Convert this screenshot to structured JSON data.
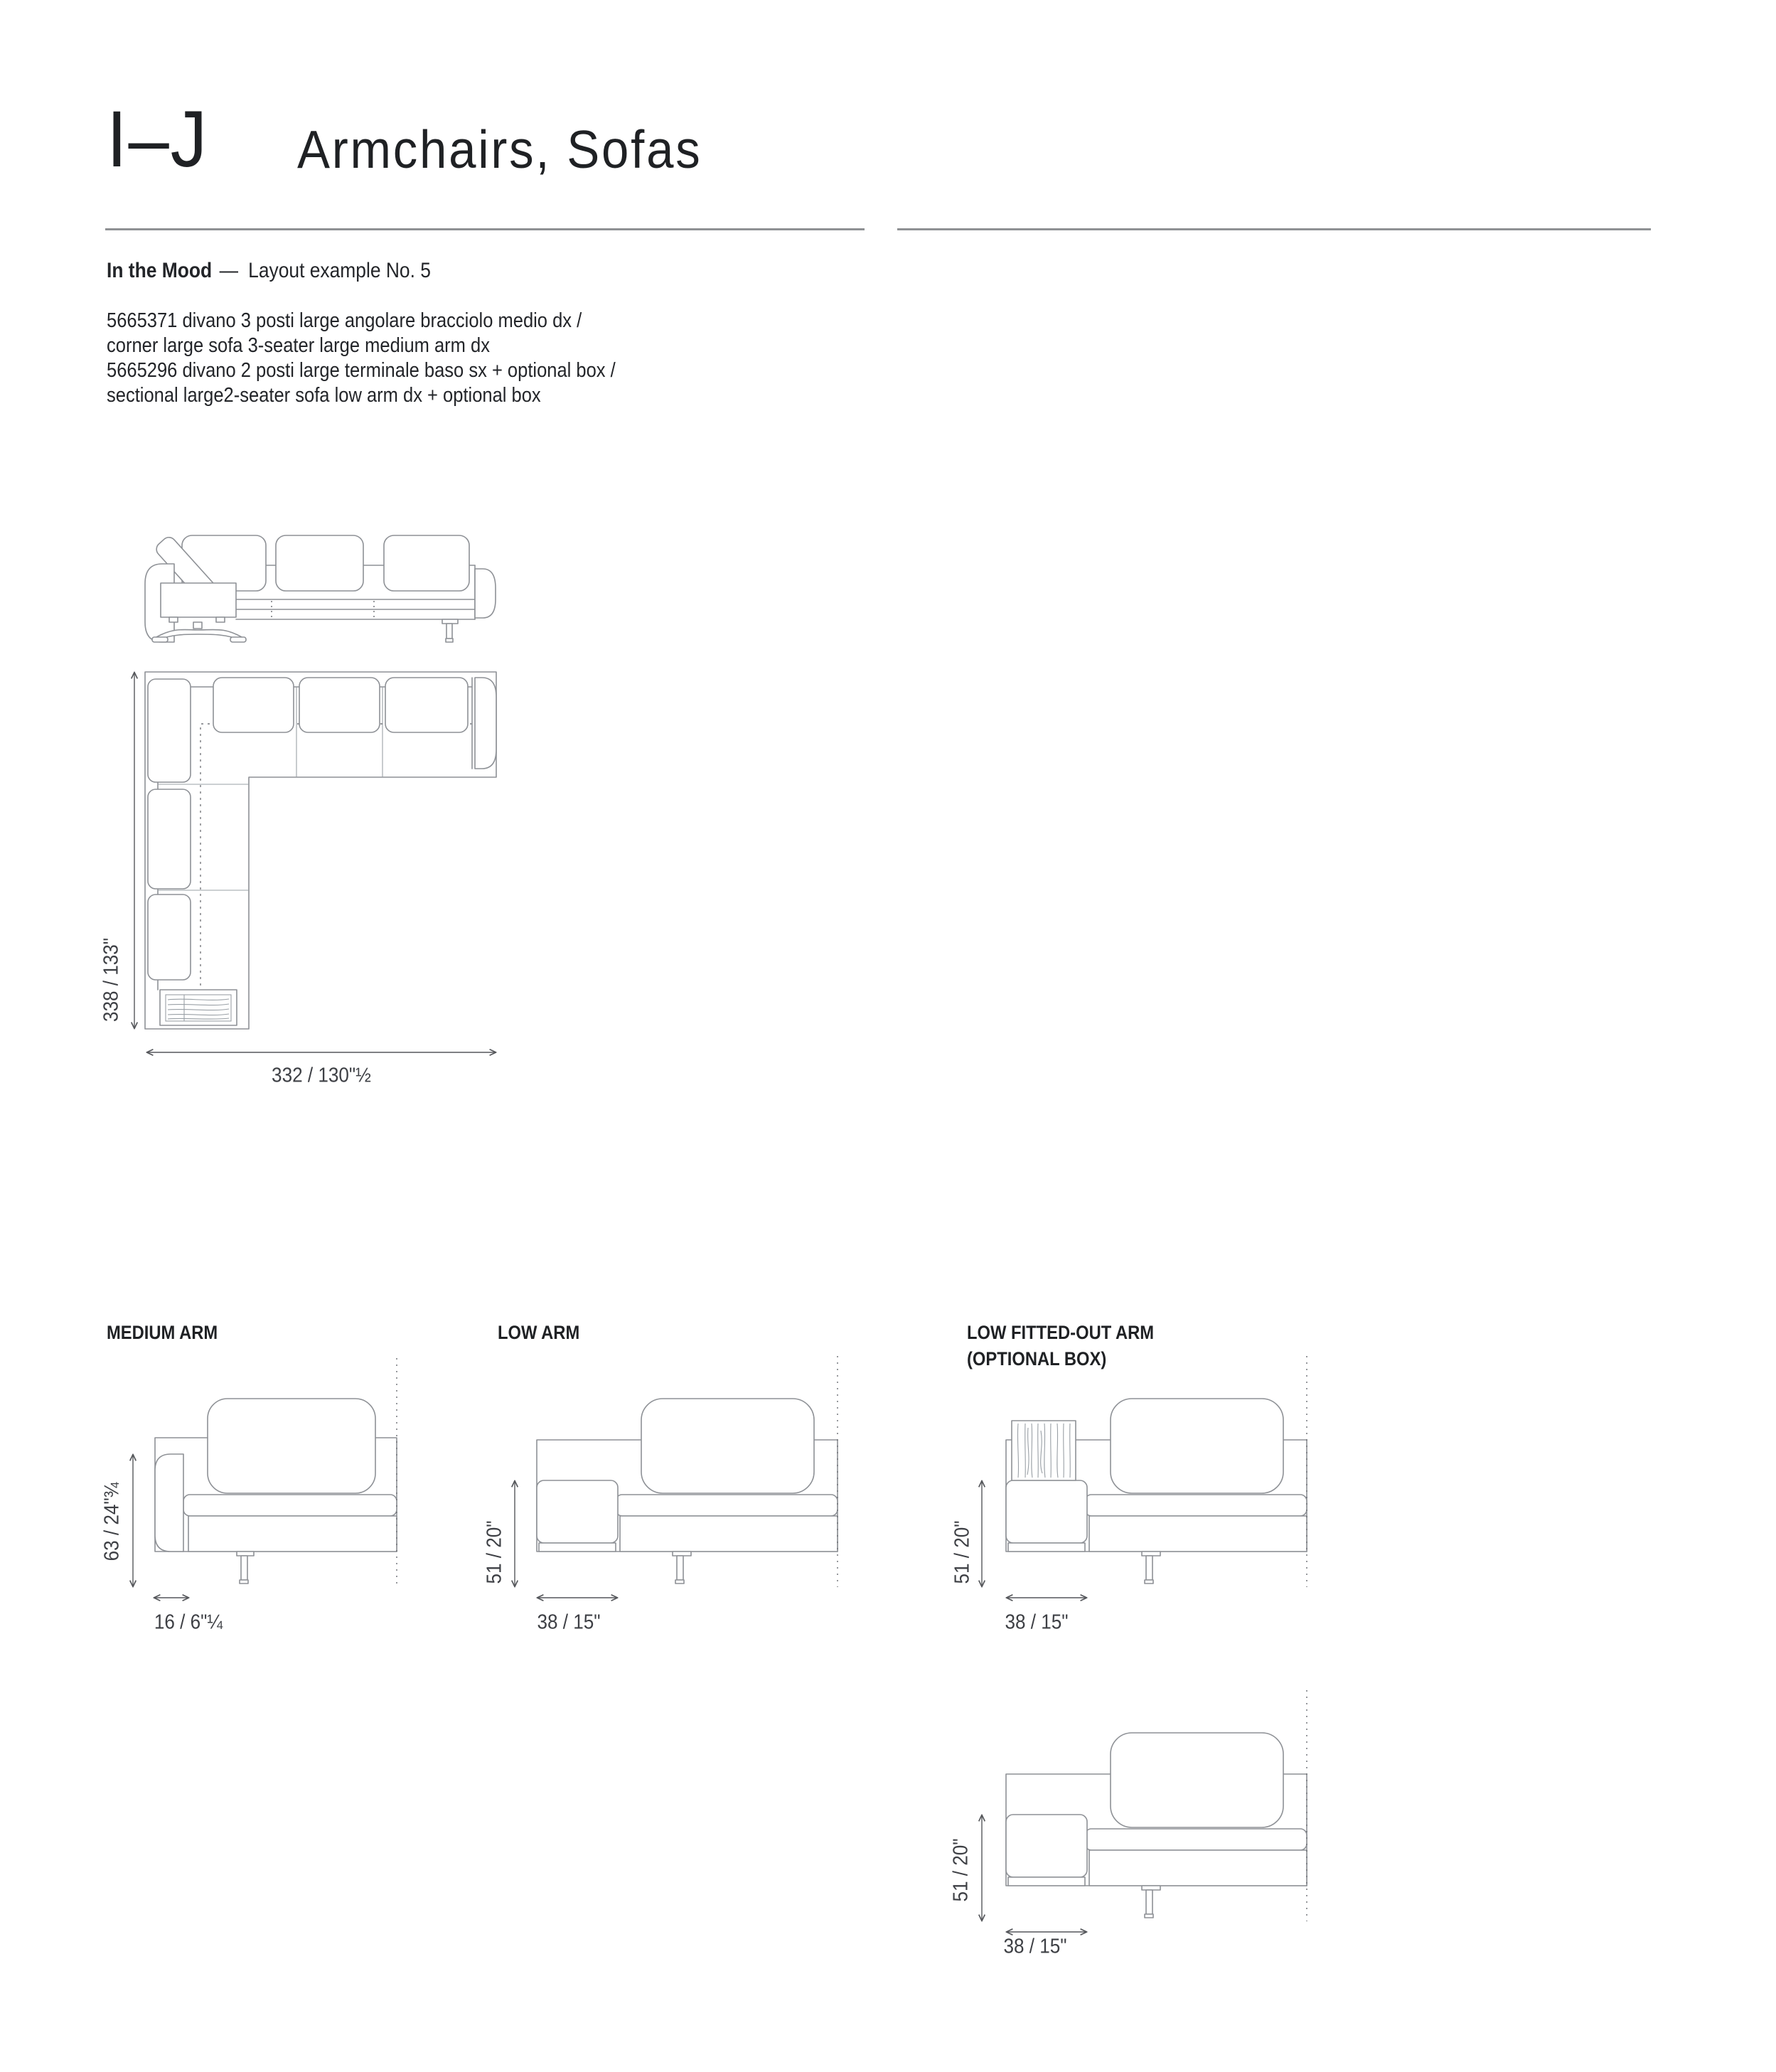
{
  "page": {
    "section_index": "I–J",
    "section_title": "Armchairs, Sofas",
    "series_name": "In the Mood",
    "series_separator": "—",
    "layout_example": "Layout example No. 5",
    "product_lines": [
      "5665371 divano 3 posti large angolare bracciolo medio dx /",
      "corner large sofa 3-seater large medium arm dx",
      "5665296 divano 2 posti large terminale baso sx + optional box /",
      "sectional large2-seater sofa low arm dx + optional box"
    ]
  },
  "layout_plan": {
    "height_dim": "338 / 133\"",
    "width_dim": "332 / 130\"½"
  },
  "details": [
    {
      "label": "MEDIUM ARM",
      "label_line2": "",
      "height_dim": "63 / 24\"¾",
      "width_dim": "16 / 6\"¼"
    },
    {
      "label": "LOW ARM",
      "label_line2": "",
      "height_dim": "51 / 20\"",
      "width_dim": "38 / 15\""
    },
    {
      "label": "LOW FITTED-OUT ARM",
      "label_line2": "(OPTIONAL BOX)",
      "height_dim": "51 / 20\"",
      "width_dim": "38 / 15\""
    },
    {
      "label": "",
      "label_line2": "",
      "height_dim": "51 / 20\"",
      "width_dim": "38 / 15\""
    }
  ]
}
